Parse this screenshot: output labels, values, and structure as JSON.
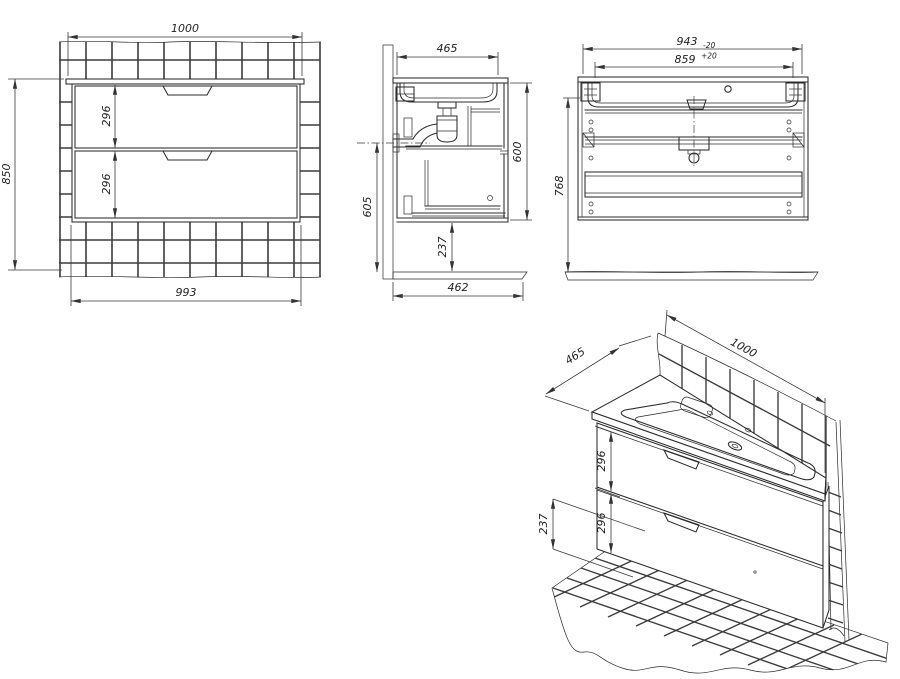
{
  "drawing": {
    "background_color": "#ffffff",
    "line_color": "#2b2b2b",
    "views": {
      "front": {
        "name": "Front view",
        "dims": {
          "width_top": "1000",
          "height_left": "850",
          "drawer_upper_height": "296",
          "drawer_lower_height": "296",
          "width_bottom": "993"
        }
      },
      "side": {
        "name": "Side section view",
        "dims": {
          "depth_top": "465",
          "height_left": "605",
          "height_right": "600",
          "floor_clearance": "237",
          "depth_bottom": "462"
        }
      },
      "back": {
        "name": "Back view",
        "dims": {
          "width_outer": "943",
          "width_outer_tolerance": "-20",
          "width_inner": "859",
          "width_inner_tolerance": "+20",
          "height_left": "768"
        }
      },
      "isometric": {
        "name": "Isometric view",
        "dims": {
          "depth": "465",
          "width": "1000",
          "drawer_upper_height": "296",
          "drawer_lower_height": "296",
          "floor_clearance": "237"
        }
      }
    }
  }
}
